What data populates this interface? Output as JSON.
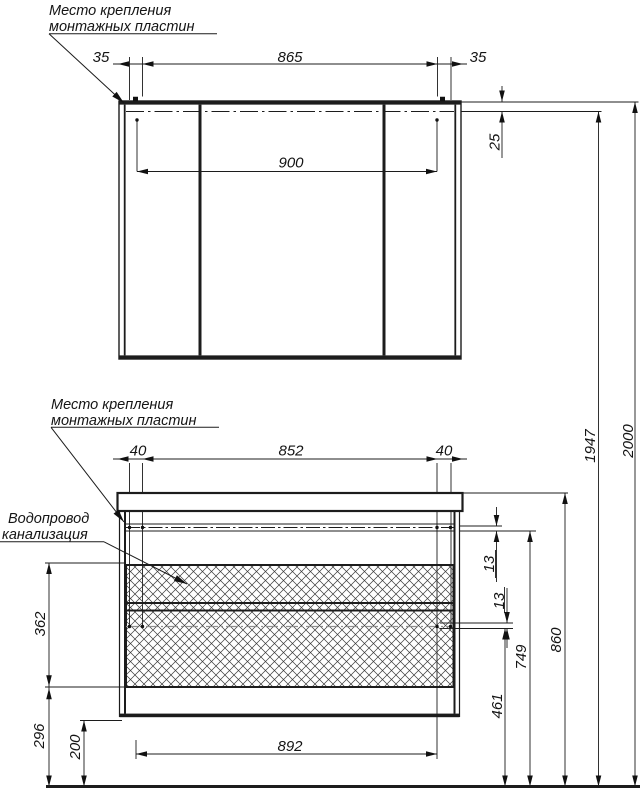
{
  "mirror": {
    "label_line1": "Место крепления",
    "label_line2": "монтажных пластин",
    "dim_offset_left": "35",
    "dim_plate_span": "865",
    "dim_offset_right": "35",
    "dim_width": "900",
    "dim_plate_drop": "25"
  },
  "vanity": {
    "label_line1": "Место крепления",
    "label_line2": "монтажных пластин",
    "plumbing_line1": "Водопровод",
    "plumbing_line2": "канализация",
    "dim_offset_left": "40",
    "dim_plate_span": "852",
    "dim_offset_right": "40",
    "dim_plate_inset_top": "13",
    "dim_plate_inset_mid": "13",
    "dim_drawer_front": "362",
    "dim_lower_front": "296",
    "dim_floor_clearance": "200",
    "dim_width_bottom": "892",
    "dim_plate_row2_height": "461",
    "dim_body_height": "749",
    "dim_countertop_height": "860"
  },
  "overall": {
    "dim_plate_height": "1947",
    "dim_total_height": "2000"
  },
  "colors": {
    "line": "#1c1c1c",
    "hatch": "#3a3a3a",
    "hidden_line": "#8f8f8f",
    "background": "#ffffff"
  }
}
